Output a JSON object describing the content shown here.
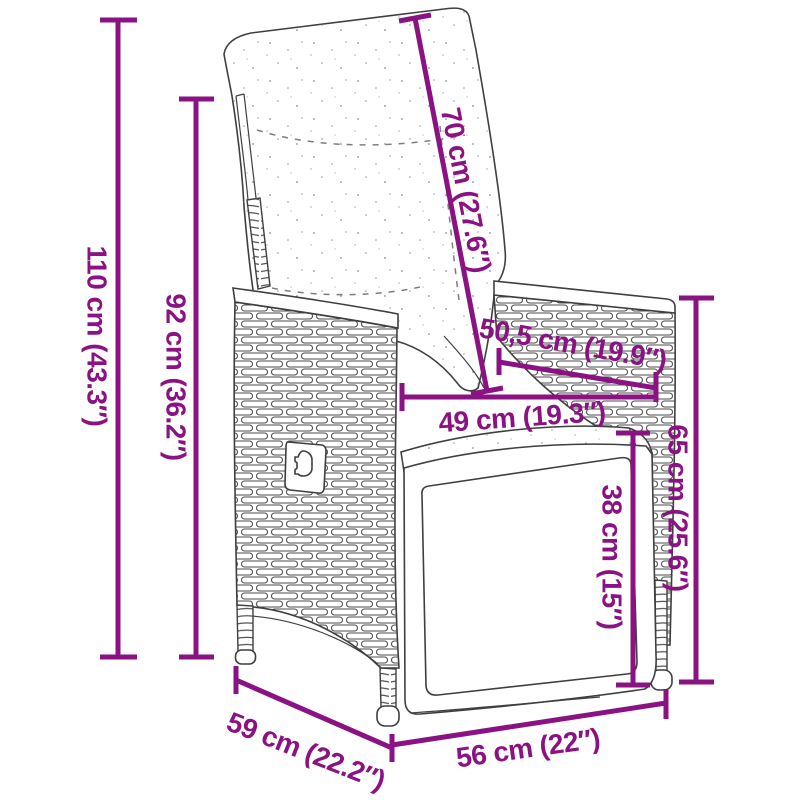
{
  "page": {
    "background_color": "#ffffff"
  },
  "diagram": {
    "subject": "Reclining garden chair with cushion - dimension drawing",
    "accent_color": "#8A1283",
    "outline_color": "#3f3f3f",
    "dimensions": {
      "total_height": "110 cm (43.3″)",
      "backrest_height": "92 cm (36.2″)",
      "backrest_length": "70 cm (27.6″)",
      "armrest_depth": "50,5 cm (19.9″)",
      "seat_width": "49 cm (19.3″)",
      "armrest_height": "65 cm (25.6″)",
      "footrest_height": "38 cm (15″)",
      "seat_depth": "59 cm (22.2″)",
      "front_width": "56 cm (22″)"
    }
  }
}
